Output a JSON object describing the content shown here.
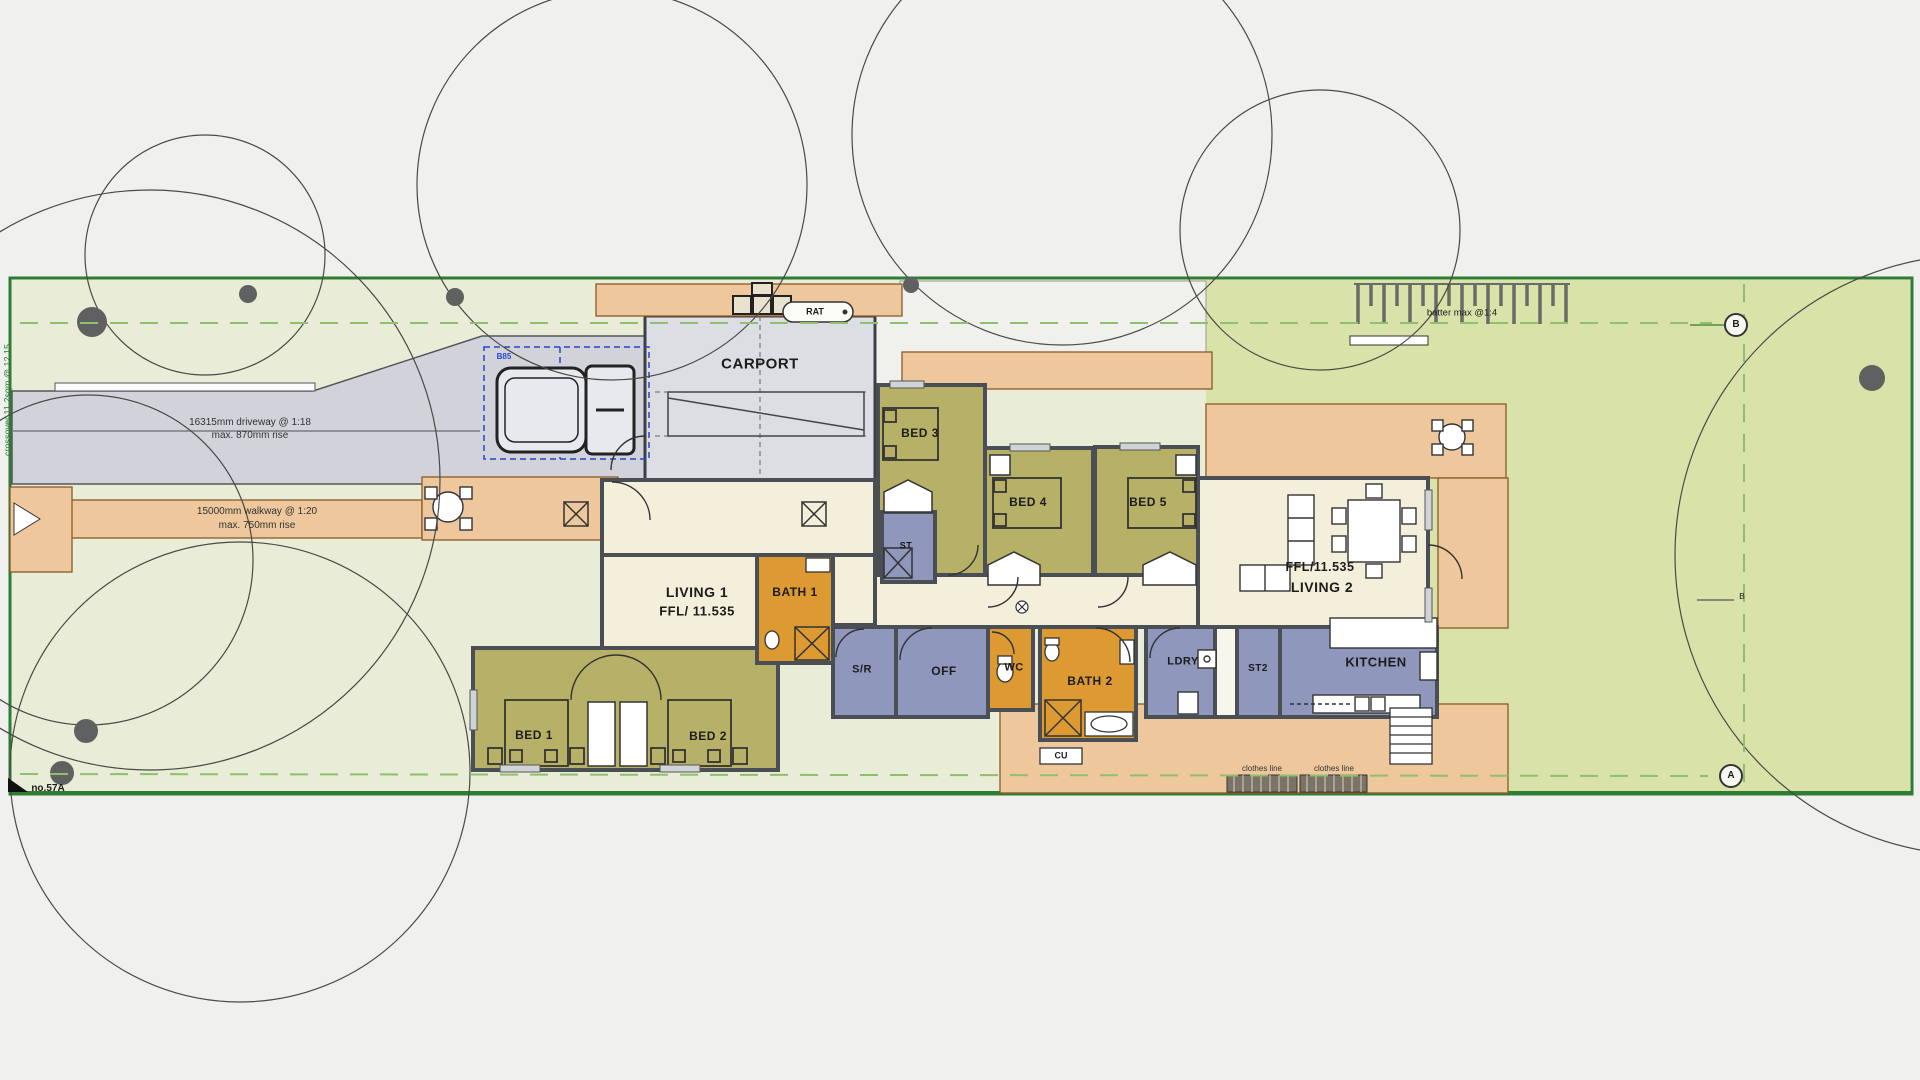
{
  "title": "Residential site and floor plan",
  "colors": {
    "boundary_green": "#2e7d32",
    "lawn": "#e9ecd6",
    "lawn_east": "#d9e3a9",
    "deck_orange": "#eec89c",
    "bedroom_olive": "#b7b168",
    "service_blue": "#8f97bd",
    "bath_amber": "#dd9a33",
    "interior_cream": "#f4efdb",
    "driveway_gray": "#d2d3da",
    "wall_dark": "#4a4f55",
    "vehicle_template_blue": "#2746c8"
  },
  "annotations": {
    "driveway": {
      "line1": "16315mm driveway @ 1:18",
      "line2": "max. 870mm rise"
    },
    "walkway": {
      "line1": "15000mm walkway @ 1:20",
      "line2": "max. 750mm rise"
    },
    "batter": "batter max @1:4",
    "boundary_left": "crossover 11.2sqm @ 12.15",
    "lot_number": "no.57A",
    "clothes_line_left": "clothes line",
    "clothes_line_right": "clothes line",
    "cu": "CU",
    "rat": "RAT",
    "b85": "B85",
    "section_marker_a": "A",
    "section_marker_b": "B",
    "section_marker_b_small": "B"
  },
  "rooms": {
    "carport": {
      "label": "CARPORT"
    },
    "bed1": {
      "label": "BED 1"
    },
    "bed2": {
      "label": "BED 2"
    },
    "bed3": {
      "label": "BED 3"
    },
    "bed4": {
      "label": "BED 4"
    },
    "bed5": {
      "label": "BED 5"
    },
    "living1": {
      "label": "LIVING 1",
      "ffl": "FFL/ 11.535"
    },
    "living2": {
      "label": "LIVING 2",
      "ffl": "FFL/11.535"
    },
    "bath1": {
      "label": "BATH 1"
    },
    "bath2": {
      "label": "BATH 2"
    },
    "wc": {
      "label": "WC"
    },
    "sr": {
      "label": "S/R"
    },
    "off": {
      "label": "OFF"
    },
    "ldry": {
      "label": "LDRY"
    },
    "st": {
      "label": "ST"
    },
    "st2": {
      "label": "ST2"
    },
    "kitchen": {
      "label": "KITCHEN"
    }
  }
}
